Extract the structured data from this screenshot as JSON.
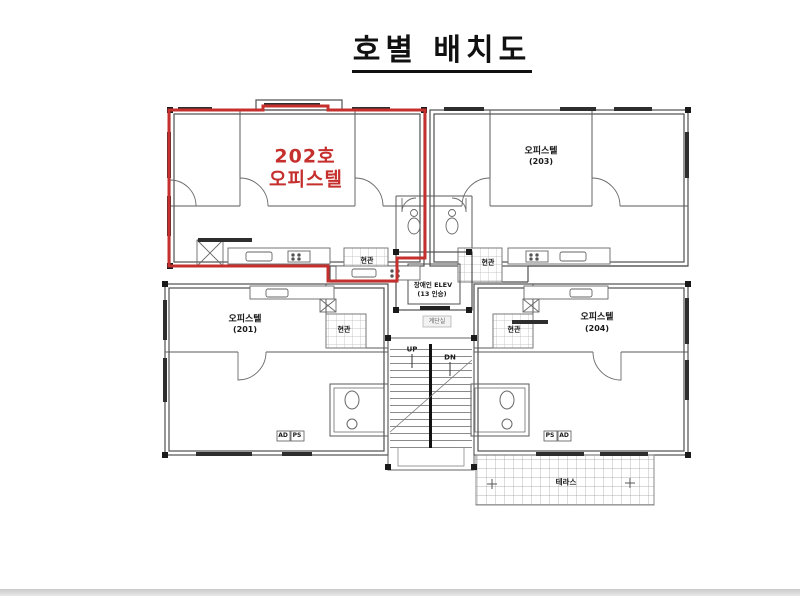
{
  "title": "호별 배치도",
  "highlight": {
    "unit_no": "202호",
    "unit_type": "오피스텔",
    "color": "#c5302e"
  },
  "units": [
    {
      "name": "오피스텔",
      "number": "(203)"
    },
    {
      "name": "오피스텔",
      "number": "(201)"
    },
    {
      "name": "오피스텔",
      "number": "(204)"
    }
  ],
  "labels": {
    "entrance": "현관",
    "elevator_line1": "장애인 ELEV",
    "elevator_line2": "(13 인승)",
    "stairs_up": "UP",
    "stairs_down": "DN",
    "stairwell": "계단실",
    "terrace": "테라스",
    "shaft_ad": "AD",
    "shaft_ps": "PS"
  },
  "colors": {
    "highlight": "#c5302e",
    "wall": "#4f4f4f",
    "detail": "#777777",
    "text": "#1a1a1a"
  }
}
